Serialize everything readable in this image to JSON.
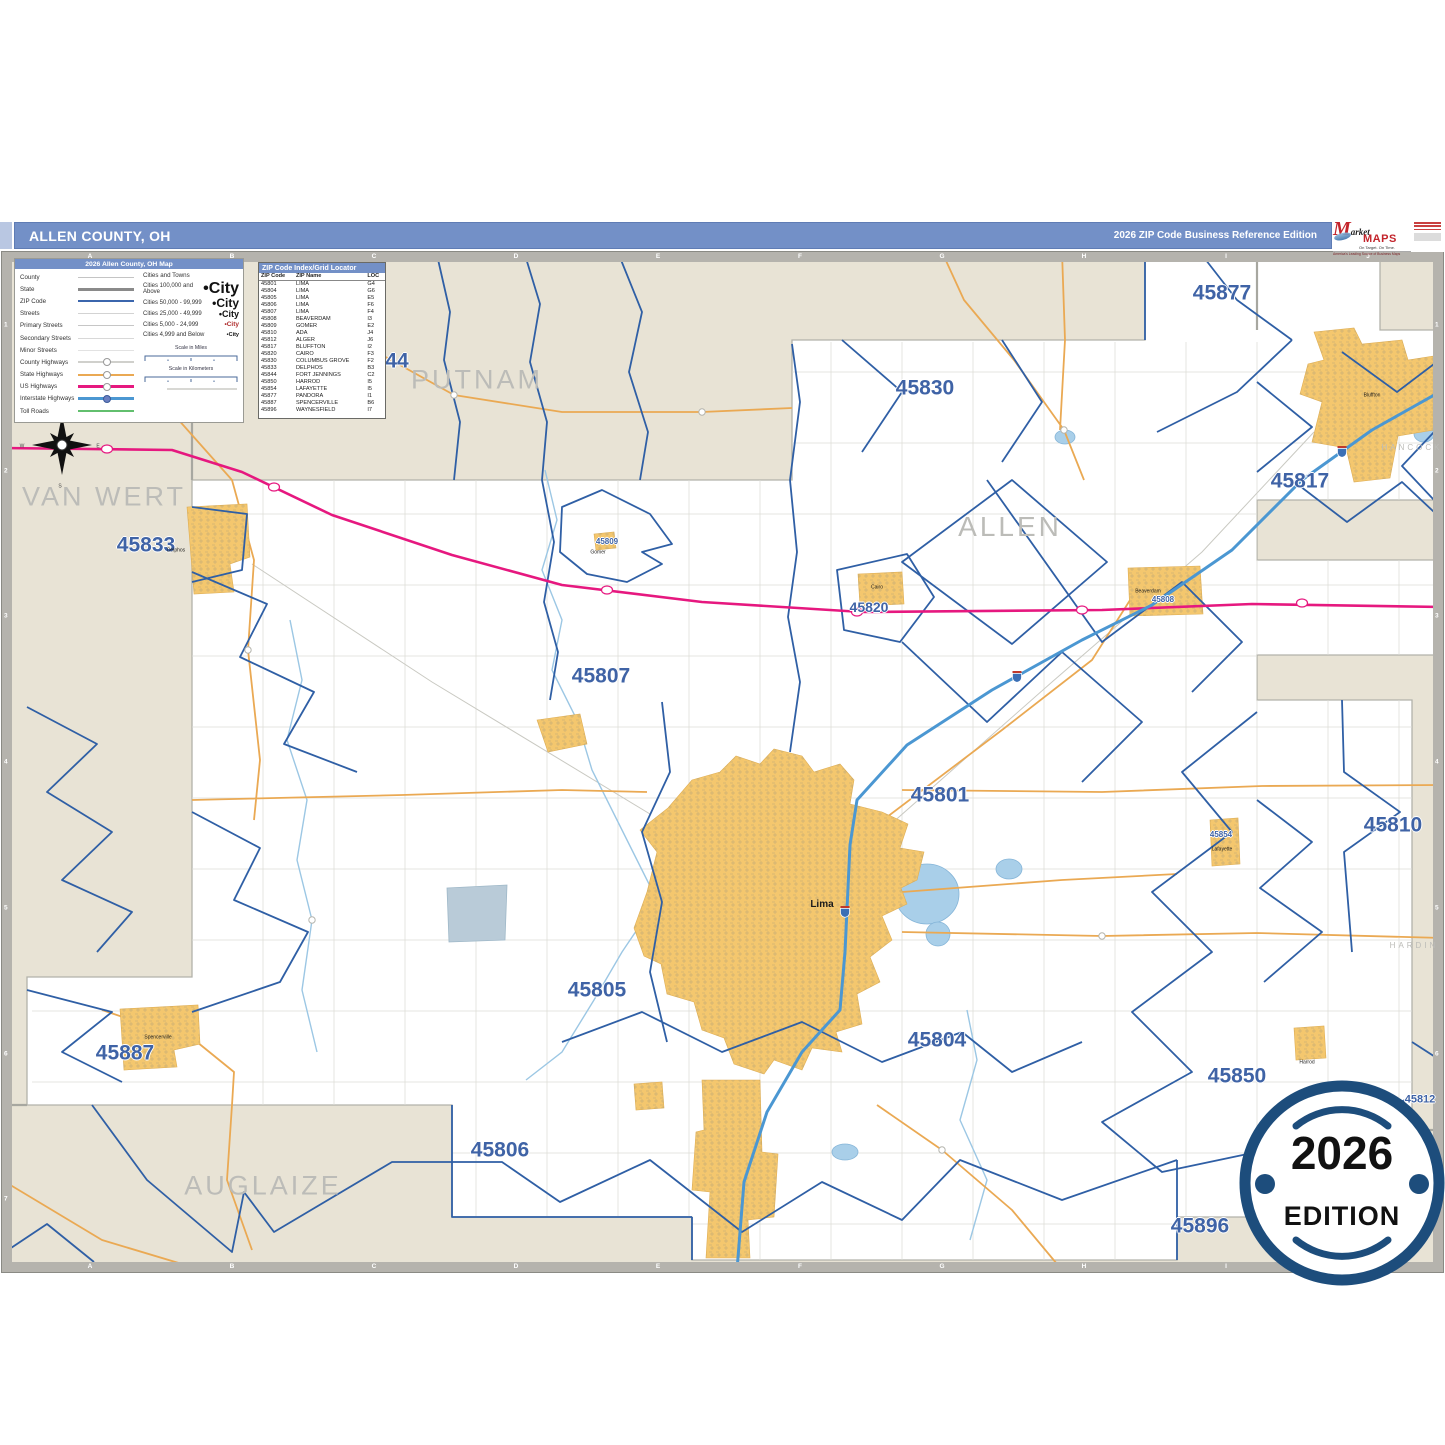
{
  "header": {
    "title": "ALLEN COUNTY, OH",
    "edition": "2026 ZIP Code Business Reference Edition"
  },
  "logo": {
    "m": "M",
    "arket": "arket",
    "maps": "MAPS",
    "tagline": "On Target.  On Time.",
    "subline": "America's Leading Source of Business Maps"
  },
  "legend": {
    "title": "2026 Allen County, OH Map",
    "items": [
      {
        "label": "County",
        "key": "county"
      },
      {
        "label": "State",
        "key": "state"
      },
      {
        "label": "ZIP Code",
        "key": "zip"
      },
      {
        "label": "Streets",
        "key": "streets"
      },
      {
        "label": "Primary Streets",
        "key": "primary"
      },
      {
        "label": "Secondary Streets",
        "key": "secondary"
      },
      {
        "label": "Minor Streets",
        "key": "minor"
      },
      {
        "label": "County Highways",
        "key": "countyhwy"
      },
      {
        "label": "State Highways",
        "key": "statehwy"
      },
      {
        "label": "US Highways",
        "key": "ushwy"
      },
      {
        "label": "Interstate Highways",
        "key": "interstate"
      },
      {
        "label": "Toll Roads",
        "key": "toll"
      }
    ],
    "cities_header": "Cities and Towns",
    "city_classes": [
      {
        "label": "Cities 100,000 and Above",
        "sample": "City",
        "px": 16
      },
      {
        "label": "Cities 50,000 - 99,999",
        "sample": "City",
        "px": 12
      },
      {
        "label": "Cities 25,000 - 49,999",
        "sample": "City",
        "px": 9
      },
      {
        "label": "Cities 5,000 - 24,999",
        "sample": "City",
        "px": 6.5
      },
      {
        "label": "Cities 4,999 and Below",
        "sample": "City",
        "px": 5.5
      }
    ],
    "scale_miles": "Scale in Miles",
    "scale_km": "Scale in Kilometers"
  },
  "zip_index": {
    "title": "ZIP Code Index/Grid Locator",
    "columns": [
      "ZIP Code",
      "ZIP Name",
      "LOC"
    ],
    "rows": [
      [
        "45801",
        "LIMA",
        "G4"
      ],
      [
        "45804",
        "LIMA",
        "G6"
      ],
      [
        "45805",
        "LIMA",
        "E5"
      ],
      [
        "45806",
        "LIMA",
        "F6"
      ],
      [
        "45807",
        "LIMA",
        "F4"
      ],
      [
        "45808",
        "BEAVERDAM",
        "I3"
      ],
      [
        "45809",
        "GOMER",
        "E2"
      ],
      [
        "45810",
        "ADA",
        "J4"
      ],
      [
        "45812",
        "ALGER",
        "J6"
      ],
      [
        "45817",
        "BLUFFTON",
        "I2"
      ],
      [
        "45820",
        "CAIRO",
        "F3"
      ],
      [
        "45830",
        "COLUMBUS GROVE",
        "F2"
      ],
      [
        "45833",
        "DELPHOS",
        "B3"
      ],
      [
        "45844",
        "FORT JENNINGS",
        "C2"
      ],
      [
        "45850",
        "HARROD",
        "I5"
      ],
      [
        "45854",
        "LAFAYETTE",
        "I5"
      ],
      [
        "45877",
        "PANDORA",
        "I1"
      ],
      [
        "45887",
        "SPENCERVILLE",
        "B6"
      ],
      [
        "45896",
        "WAYNESFIELD",
        "I7"
      ]
    ]
  },
  "grid": {
    "cols": [
      "A",
      "B",
      "C",
      "D",
      "E",
      "F",
      "G",
      "H",
      "I",
      "J"
    ],
    "rows": [
      "1",
      "2",
      "3",
      "4",
      "5",
      "6",
      "7"
    ]
  },
  "map_labels": {
    "counties": [
      {
        "text": "PUTNAM",
        "x": 477,
        "y": 380,
        "px": 27
      },
      {
        "text": "VAN WERT",
        "x": 104,
        "y": 497,
        "px": 27
      },
      {
        "text": "ALLEN",
        "x": 1010,
        "y": 527,
        "px": 28
      },
      {
        "text": "AUGLAIZE",
        "x": 263,
        "y": 1186,
        "px": 27
      },
      {
        "text": "HANCOCK",
        "x": 1412,
        "y": 448,
        "px": 8
      },
      {
        "text": "HARDIN",
        "x": 1414,
        "y": 946,
        "px": 8
      }
    ],
    "zips": [
      {
        "text": "45877",
        "x": 1222,
        "y": 293,
        "px": 21
      },
      {
        "text": "45830",
        "x": 925,
        "y": 388,
        "px": 21
      },
      {
        "text": "45817",
        "x": 1300,
        "y": 481,
        "px": 21
      },
      {
        "text": "45833",
        "x": 146,
        "y": 545,
        "px": 21
      },
      {
        "text": "45820",
        "x": 869,
        "y": 607,
        "px": 14
      },
      {
        "text": "45807",
        "x": 601,
        "y": 676,
        "px": 21
      },
      {
        "text": "45801",
        "x": 940,
        "y": 795,
        "px": 21
      },
      {
        "text": "45810",
        "x": 1393,
        "y": 825,
        "px": 21
      },
      {
        "text": "45805",
        "x": 597,
        "y": 990,
        "px": 21
      },
      {
        "text": "45804",
        "x": 937,
        "y": 1040,
        "px": 21
      },
      {
        "text": "45887",
        "x": 125,
        "y": 1053,
        "px": 21
      },
      {
        "text": "45850",
        "x": 1237,
        "y": 1076,
        "px": 21
      },
      {
        "text": "45806",
        "x": 500,
        "y": 1150,
        "px": 21
      },
      {
        "text": "45896",
        "x": 1200,
        "y": 1226,
        "px": 21
      },
      {
        "text": "45812",
        "x": 1420,
        "y": 1100,
        "px": 11
      },
      {
        "text": "44",
        "x": 397,
        "y": 361,
        "px": 21
      },
      {
        "text": "45809",
        "x": 607,
        "y": 542,
        "px": 8
      },
      {
        "text": "45808",
        "x": 1163,
        "y": 600,
        "px": 8
      },
      {
        "text": "45854",
        "x": 1221,
        "y": 835,
        "px": 8
      }
    ],
    "cities": [
      {
        "text": "Lima",
        "x": 822,
        "y": 905,
        "px": 10,
        "bold": true
      },
      {
        "text": "Delphos",
        "x": 176,
        "y": 551,
        "px": 5
      },
      {
        "text": "Spencerville",
        "x": 158,
        "y": 1038,
        "px": 5
      },
      {
        "text": "Bluffton",
        "x": 1372,
        "y": 396,
        "px": 5
      },
      {
        "text": "Beaverdam",
        "x": 1148,
        "y": 592,
        "px": 5
      },
      {
        "text": "Cairo",
        "x": 877,
        "y": 588,
        "px": 5
      },
      {
        "text": "Gomer",
        "x": 598,
        "y": 553,
        "px": 5
      },
      {
        "text": "Lafayette",
        "x": 1222,
        "y": 850,
        "px": 5
      },
      {
        "text": "Harrod",
        "x": 1307,
        "y": 1063,
        "px": 5
      }
    ],
    "compass": [
      {
        "text": "N",
        "x": 60,
        "y": 408
      },
      {
        "text": "E",
        "x": 98,
        "y": 447
      },
      {
        "text": "S",
        "x": 60,
        "y": 487
      },
      {
        "text": "W",
        "x": 22,
        "y": 447
      }
    ]
  },
  "badge": {
    "year": "2026",
    "word": "EDITION"
  },
  "colors": {
    "header_blue": "#7390c7",
    "badge_navy": "#1d4d7c",
    "zip_boundary_blue": "#2f5fa5",
    "zip_label_blue": "#3f63a6",
    "county_label_gray": "#bcbcb8",
    "out_of_county_beige": "#e8e3d5",
    "town_yellow": "#f4c76e",
    "us_highway_pink": "#e6187f",
    "interstate_blue": "#4b97d2",
    "state_highway_orange": "#eaa953",
    "river_blue": "#9cc7e4",
    "grid_band_gray": "#b5b3ad",
    "brand_red": "#c3242b"
  }
}
